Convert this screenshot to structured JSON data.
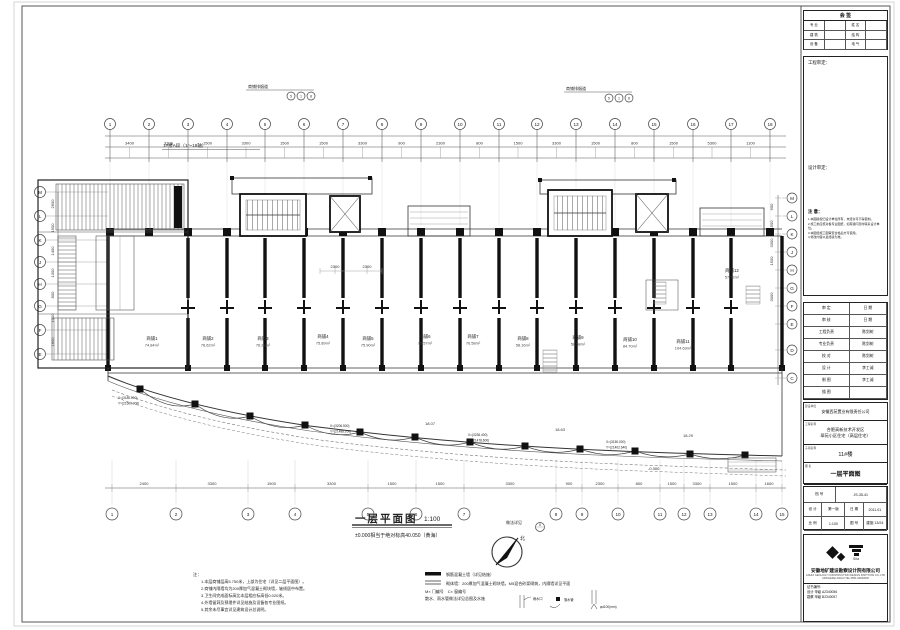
{
  "sheet": {
    "title": "一层平面图",
    "scale": "1:100",
    "subtitle": "±0.000相当于绝对标高40.050（黄海）",
    "section_label": "1#楼A段（1～18轴）",
    "north": "北",
    "detail_ref": {
      "label": "做法详见",
      "num": "5"
    },
    "vent": {
      "label": "商铺排烟道",
      "circles": [
        "5",
        "1",
        "8"
      ]
    }
  },
  "axes": {
    "top": [
      "1",
      "2",
      "3",
      "4",
      "5",
      "6",
      "7",
      "8",
      "9",
      "10",
      "11",
      "12",
      "13",
      "14",
      "15",
      "16",
      "17",
      "18"
    ],
    "bottom": [
      "1",
      "2",
      "3",
      "4",
      "5",
      "6",
      "7",
      "8",
      "9",
      "10",
      "11",
      "12",
      "13",
      "14",
      "15"
    ],
    "left": [
      "M",
      "L",
      "K",
      "J",
      "H",
      "G",
      "F",
      "E"
    ],
    "right": [
      "M",
      "L",
      "K",
      "J",
      "H",
      "G",
      "F",
      "E",
      "D",
      "C"
    ]
  },
  "dims": {
    "top": [
      "3400",
      "3300",
      "1500",
      "3300",
      "1500",
      "1500",
      "3300",
      "900",
      "2300",
      "800",
      "1500",
      "3300",
      "1500",
      "800",
      "1500",
      "5300",
      "1100"
    ],
    "bottom": [
      "2400",
      "3300",
      "1500",
      "3300",
      "1500",
      "1500",
      "3300",
      "900",
      "2300",
      "800",
      "1500",
      "3300",
      "1500",
      "1600"
    ],
    "left": [
      "2600",
      "1500",
      "1400",
      "1300",
      "800",
      "1000",
      "1800"
    ],
    "right": [
      "600",
      "1500",
      "3300",
      "1500",
      "3000"
    ],
    "inner": [
      "2300",
      "2300"
    ],
    "curve": [
      "18.07",
      "18.63",
      "18.29"
    ],
    "level": "-0.300"
  },
  "shops": [
    {
      "n": "商铺1",
      "a": "74.84m²"
    },
    {
      "n": "商铺2",
      "a": "76.62m²"
    },
    {
      "n": "商铺3",
      "a": "76.29m²"
    },
    {
      "n": "商铺4",
      "a": "75.89m²"
    },
    {
      "n": "商铺5",
      "a": "75.90m²"
    },
    {
      "n": "商铺6",
      "a": "75.57m²"
    },
    {
      "n": "商铺7",
      "a": "76.58m²"
    },
    {
      "n": "商铺8",
      "a": "58.16m²"
    },
    {
      "n": "商铺9",
      "a": "58.58m²"
    },
    {
      "n": "商铺10",
      "a": "84.70m²"
    },
    {
      "n": "商铺11",
      "a": "104.63m²"
    },
    {
      "n": "商铺12",
      "a": "57.72m²"
    }
  ],
  "coords": [
    {
      "x": "X=(3180.000)",
      "y": "Y=(21500.000)"
    },
    {
      "x": "X=(3206.500)",
      "y": "Y=(21488.200)"
    },
    {
      "x": "X=(3236.400)",
      "y": "Y=(21478.600)"
    },
    {
      "x": "X=(3150.000)",
      "y": "Y=(21402.640)"
    }
  ],
  "notes": {
    "header": "注：",
    "lines": [
      "1.本层商铺层高5.750米，上部为住宅（详见二层平面图）。",
      "2.商铺内隔墙均为200厚加气混凝土砌块墙，轴线居中布置。",
      "3.卫生间完成面标高比本层相应标高低0.020米。",
      "4.外墙留洞及预埋件详见结施及设备各专业图纸。",
      "5.其余未尽事宜详见建筑设计总说明。"
    ]
  },
  "legend": {
    "items": [
      "钢筋混凝土墙（详见结施）",
      "砌体墙：200厚加气混凝土砌块墙，M5混合砂浆砌筑，内隔墙详见平面",
      "M× 门编号　C× 窗编号",
      "散水、雨水管做法详见总图及水施"
    ],
    "details": [
      "雨水口",
      "落水管",
      "φd100(mm)"
    ]
  },
  "titleblock": {
    "sign_table": {
      "title": "会 签",
      "labels": [
        "专 业",
        "姓 名",
        "建 筑",
        "结 构",
        "设 备",
        "电 气"
      ]
    },
    "approve_box": {
      "label1": "工程审定：",
      "label2": "设计审定：",
      "notice_title": "注 意：",
      "notice_lines": [
        "1.本图版权归设计单位所有，未经许可不得复制。",
        "2.施工前应核对各专业图纸，如有疑问及时联系设计单位。",
        "3.本图经施工图审查合格后方可使用。",
        "4.修改内容以最终版为准。"
      ]
    },
    "personnel": [
      [
        "审 定",
        "日 期"
      ],
      [
        "审 核",
        "日 期"
      ],
      [
        "工程负责",
        "陈剑树"
      ],
      [
        "专业负责",
        "陈剑树"
      ],
      [
        "校 对",
        "陈剑树"
      ],
      [
        "设 计",
        "李工诚"
      ],
      [
        "制 图",
        "李工诚"
      ],
      [
        "描 图",
        ""
      ]
    ],
    "blocks": {
      "owner_label": "建设单位",
      "owner": "安徽西苑置业有限责任公司",
      "project_label": "工程名称",
      "project_line1": "合肥高新技术开发区",
      "project_line2": "翠苑小区住宅（高层住宅）",
      "sub_label": "子项名称",
      "sub": "11#楼",
      "dwg_label": "图 名",
      "dwg": "一层平面图"
    },
    "num_table": {
      "archive_label": "档 号",
      "archive": "JS-35-41",
      "design_label": "设 计",
      "design": "第一版",
      "date_label": "日 期",
      "date": "2011.01",
      "scale_label": "比 例",
      "scale": "1:100",
      "no_label": "图 号",
      "no": "建施 13/24"
    },
    "company": {
      "logo_text": "Sita",
      "name": "安徽地矿建设勘察设计院有限公司",
      "addr1": "ANHUI GEOLOGY CONSTRUCTION DESIGN INSTITUTE CO.,LTD",
      "addr2": "ADD:HEFEI ANHUI  TEL:0551-62820000",
      "cert_title": "证书编号：",
      "cert1": "设计 甲级 A2340056",
      "cert2": "勘察 甲级 B2340057"
    }
  },
  "colors": {
    "line": "#222",
    "wall": "#111",
    "dim": "#333"
  }
}
